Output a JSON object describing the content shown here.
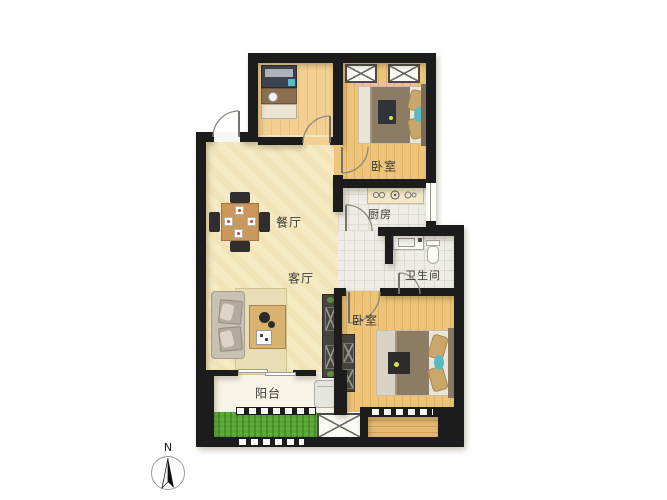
{
  "plan": {
    "rooms": {
      "bedroom_top": {
        "label": "卧室"
      },
      "bedroom_bottom": {
        "label": "卧室"
      },
      "kitchen": {
        "label": "厨房"
      },
      "bathroom": {
        "label": "卫生间"
      },
      "dining": {
        "label": "餐厅"
      },
      "living": {
        "label": "客厅"
      },
      "balcony": {
        "label": "阳台"
      }
    },
    "compass": {
      "north_label": "N"
    }
  },
  "colors": {
    "wall": "#1c1c1c",
    "living_floor": "#f6eac2",
    "study_floor": "#f3d092",
    "wood_floor": "#eec479",
    "tile_floor": "#edece6",
    "balcony_floor": "#f8f5e8",
    "grass": "#57a437",
    "duvet": "#8d7c64",
    "pillow": "#c9a66a",
    "accent_teal": "#5ab9c3",
    "label_text": "#3a3a3a"
  }
}
